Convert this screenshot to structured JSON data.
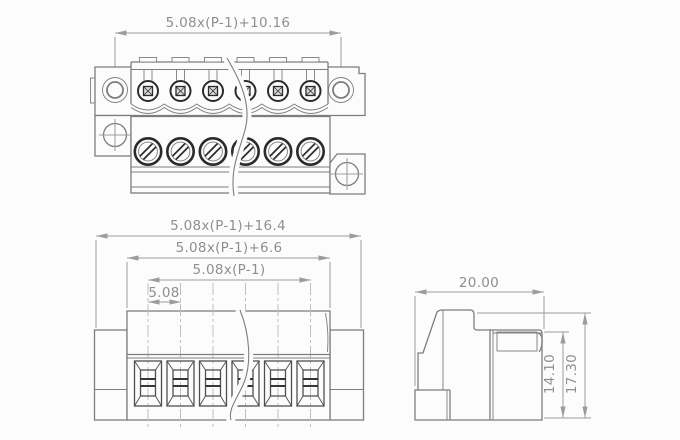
{
  "drawing": {
    "type": "technical-drawing",
    "subject": "pluggable terminal block connector, three orthographic views",
    "positions_shown": 6
  },
  "views": {
    "top": {
      "name": "top-view",
      "dims": {
        "hole_span": "5.08x(P-1)+10.16"
      }
    },
    "front": {
      "name": "front-view",
      "dims": {
        "overall": "5.08x(P-1)+16.4",
        "body": "5.08x(P-1)+6.6",
        "pitch_span": "5.08x(P-1)",
        "pitch": "5.08"
      }
    },
    "side": {
      "name": "side-view",
      "dims": {
        "depth": "20.00",
        "inner_height": "14.10",
        "overall_height": "17.30"
      }
    }
  },
  "colors": {
    "bg": "#fcfcfc",
    "outline": "#7d7d7d",
    "dark": "#2b2b2b",
    "medium": "#4f4f4f",
    "dimension": "#9c9c9c",
    "text": "#8f8f8f",
    "centerline": "#bfbfbf"
  }
}
